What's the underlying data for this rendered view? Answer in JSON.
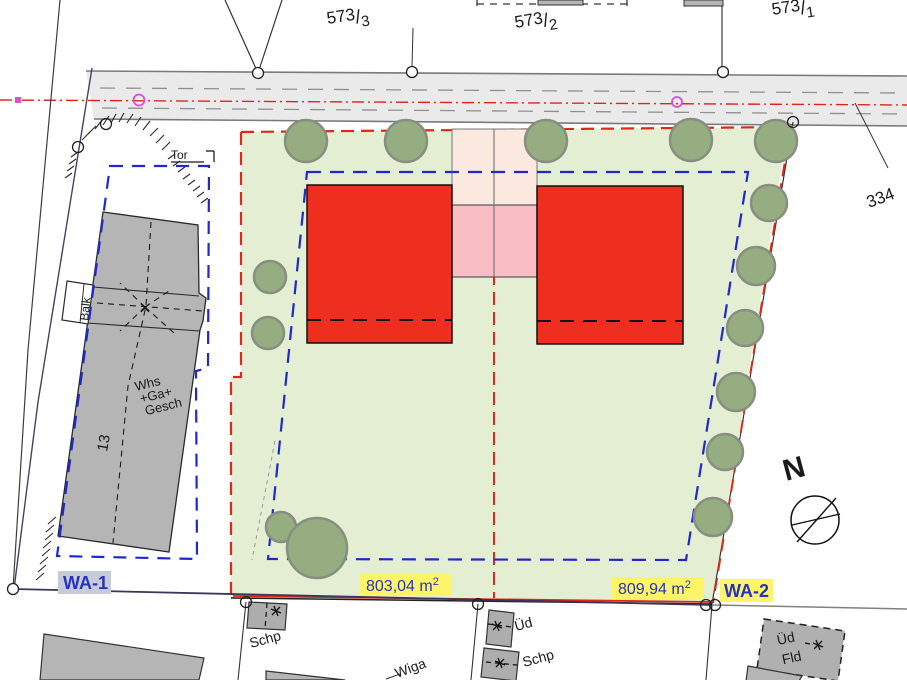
{
  "map_type": "cadastral-site-plan",
  "parcels": {
    "slash": "/",
    "p1": {
      "num": "573",
      "den": "3"
    },
    "p2": {
      "num": "573",
      "den": "2"
    },
    "p3": {
      "num": "573",
      "den": "1"
    },
    "label334": "334"
  },
  "zones": {
    "wa1": "WA-1",
    "wa2": "WA-2",
    "area_left": {
      "text": "803,04 m",
      "sup": "2"
    },
    "area_right": {
      "text": "809,94 m",
      "sup": "2"
    }
  },
  "annotations": {
    "gate": "Tor",
    "balcony": "Balk",
    "house_number": "13",
    "main_building": {
      "l1": "Whs",
      "l2": "+Ga+",
      "l3": "Gesch"
    },
    "shed_left": "Schp",
    "wiga": "Wiga",
    "ued": "Üd",
    "shed_right": "Schp",
    "ued_fld": {
      "l1": "Üd",
      "l2": "Fld"
    },
    "north": "N"
  },
  "icons": {
    "demolition_marker": "✱",
    "survey_point": "○",
    "compass": "⊕"
  },
  "colors": {
    "plot_green": "#e4eed3",
    "building_red": "#ee2e1e",
    "garage_pink": "#f8bdc5",
    "access_cream": "#fbe9df",
    "envelope_blue_dash": "#2028c8",
    "boundary_red_dash": "#e02818",
    "highlight_yellow": "#fdf46a",
    "wa1_bg": "#c6cbd7",
    "label_blue": "#2733c0",
    "road_gray": "#eaeaea",
    "tree_green": "#96ad82",
    "building_gray": "#b5b5b5",
    "magenta_marker": "#d84fd8"
  }
}
